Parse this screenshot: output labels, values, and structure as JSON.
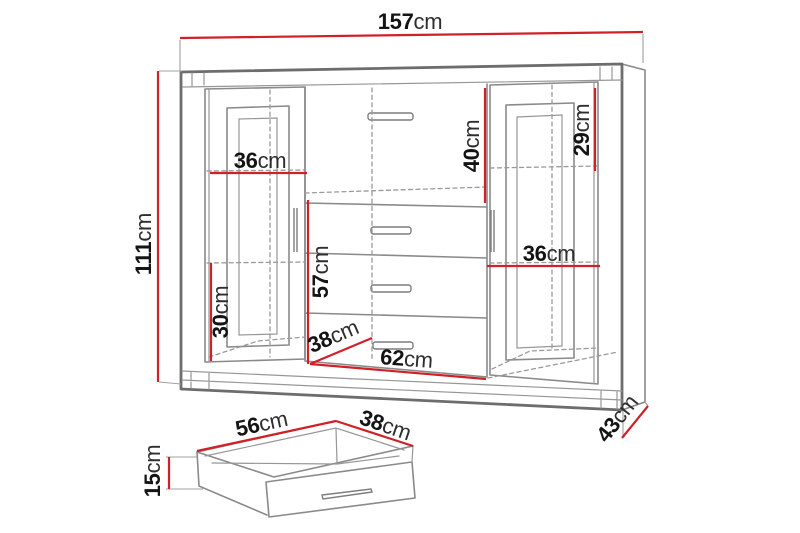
{
  "cabinet": {
    "overall_width": {
      "value": "157",
      "unit": "cm"
    },
    "overall_height": {
      "value": "111",
      "unit": "cm"
    },
    "overall_depth": {
      "value": "43",
      "unit": "cm"
    },
    "left_compartment_width": {
      "value": "36",
      "unit": "cm"
    },
    "top_section_height": {
      "value": "40",
      "unit": "cm"
    },
    "right_top_section_height": {
      "value": "29",
      "unit": "cm"
    },
    "drawer_section_height": {
      "value": "57",
      "unit": "cm"
    },
    "left_bottom_section_height": {
      "value": "30",
      "unit": "cm"
    },
    "right_compartment_width": {
      "value": "36",
      "unit": "cm"
    },
    "center_section_width": {
      "value": "62",
      "unit": "cm"
    },
    "center_section_depth": {
      "value": "38",
      "unit": "cm"
    }
  },
  "drawer": {
    "width": {
      "value": "56",
      "unit": "cm"
    },
    "depth": {
      "value": "38",
      "unit": "cm"
    },
    "height": {
      "value": "15",
      "unit": "cm"
    }
  },
  "colors": {
    "dimension_line": "#cf2127",
    "drawing_line": "#8a8a8a",
    "drawing_line_dark": "#6d6d6d",
    "label_number": "#141414",
    "label_unit": "#2e2e2e",
    "background": "#ffffff"
  }
}
